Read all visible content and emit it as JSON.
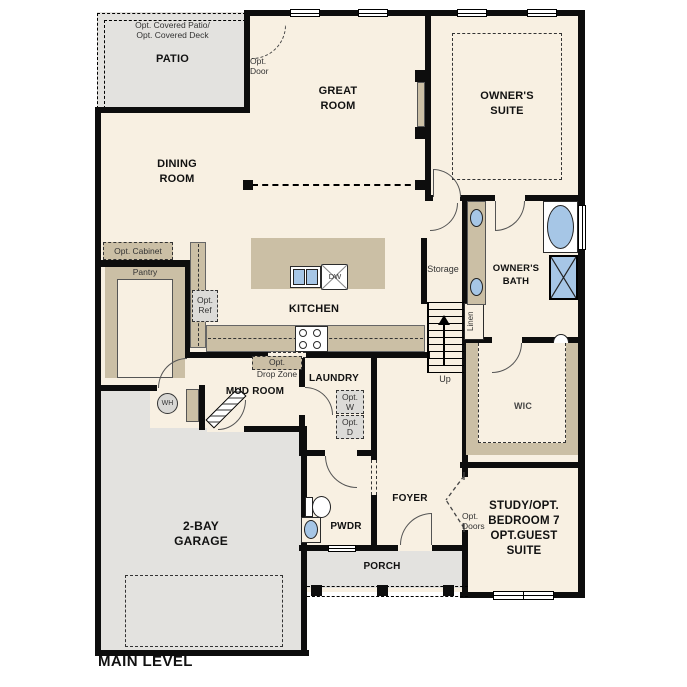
{
  "title": "MAIN LEVEL",
  "rooms": {
    "patio": {
      "opt1": "Opt. Covered Patio/",
      "opt2": "Opt. Covered Deck",
      "name": "PATIO"
    },
    "great_room": {
      "line1": "GREAT",
      "line2": "ROOM"
    },
    "owners_suite": {
      "line1": "OWNER'S",
      "line2": "SUITE"
    },
    "dining_room": {
      "line1": "DINING",
      "line2": "ROOM"
    },
    "kitchen": {
      "name": "KITCHEN"
    },
    "owners_bath": {
      "line1": "OWNER'S",
      "line2": "BATH"
    },
    "storage": {
      "name": "Storage"
    },
    "linen": {
      "name": "Linen"
    },
    "wic": {
      "name": "WIC"
    },
    "mud_room": {
      "name": "MUD ROOM"
    },
    "laundry": {
      "name": "LAUNDRY"
    },
    "pwdr": {
      "name": "PWDR"
    },
    "foyer": {
      "name": "FOYER"
    },
    "porch": {
      "name": "PORCH"
    },
    "garage": {
      "line1": "2-BAY",
      "line2": "GARAGE"
    },
    "study": {
      "line1": "STUDY/OPT.",
      "line2": "BEDROOM 7",
      "line3": "OPT.GUEST",
      "line4": "SUITE"
    }
  },
  "annotations": {
    "opt_door": {
      "line1": "Opt.",
      "line2": "Door"
    },
    "opt_cabinet": "Opt. Cabinet",
    "pantry": "Pantry",
    "opt_ref": {
      "line1": "Opt.",
      "line2": "Ref"
    },
    "opt_drop_zone": {
      "line1": "Opt.",
      "line2": "Drop Zone"
    },
    "opt_w": {
      "line1": "Opt.",
      "line2": "W"
    },
    "opt_d": {
      "line1": "Opt.",
      "line2": "D"
    },
    "opt_doors": {
      "line1": "Opt.",
      "line2": "Doors"
    },
    "up": "Up",
    "wh": "WH",
    "dw": "DW"
  },
  "colors": {
    "floor": "#f8f0e2",
    "outdoor_gray": "#e3e2df",
    "cabinet_tan": "#cbbfa5",
    "fixture_blue": "#a6c6e6",
    "wall_black": "#0d0d0d"
  }
}
